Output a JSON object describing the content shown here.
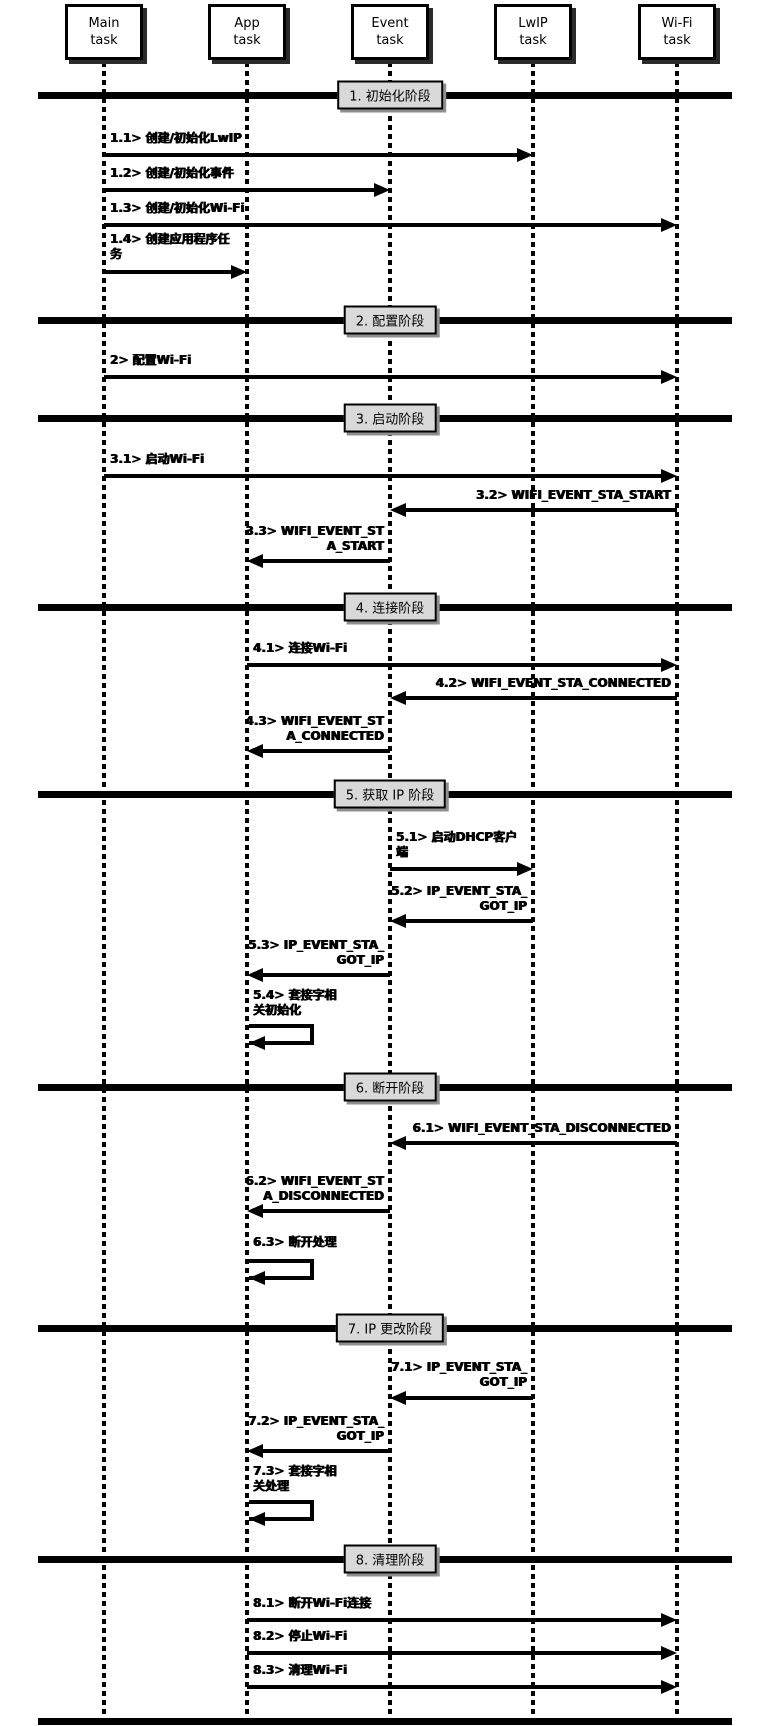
{
  "diagram": {
    "colors": {
      "line": "#000000",
      "phase_fill": "#d9d9d9",
      "box_fill": "#ffffff",
      "background": "#ffffff"
    },
    "tasks": [
      {
        "id": "main-task",
        "label": "Main task",
        "lines": [
          "Main",
          "task"
        ],
        "x": 104
      },
      {
        "id": "app-task",
        "label": "App task",
        "lines": [
          "App",
          "task"
        ],
        "x": 247
      },
      {
        "id": "event-task",
        "label": "Event task",
        "lines": [
          "Event",
          "task"
        ],
        "x": 390
      },
      {
        "id": "lwip-task",
        "label": "LwIP task",
        "lines": [
          "LwIP",
          "task"
        ],
        "x": 533
      },
      {
        "id": "wifi-task",
        "label": "Wi-Fi task",
        "lines": [
          "Wi-Fi",
          "task"
        ],
        "x": 677
      }
    ],
    "phases": [
      {
        "label": "1. 初始化阶段",
        "y": 95
      },
      {
        "label": "2. 配置阶段",
        "y": 320
      },
      {
        "label": "3. 启动阶段",
        "y": 418
      },
      {
        "label": "4. 连接阶段",
        "y": 607
      },
      {
        "label": "5. 获取 IP 阶段",
        "y": 794
      },
      {
        "label": "6. 断开阶段",
        "y": 1087
      },
      {
        "label": "7. IP 更改阶段",
        "y": 1328
      },
      {
        "label": "8. 清理阶段",
        "y": 1559
      },
      {
        "label": "",
        "y": 1721
      }
    ],
    "messages": [
      {
        "id": "1.1",
        "lines": [
          "1.1> 创建/初始化LwIP"
        ],
        "from": "main-task",
        "to": "lwip-task",
        "kind": "arrow",
        "y": 155,
        "label_y": 131
      },
      {
        "id": "1.2",
        "lines": [
          "1.2> 创建/初始化事件"
        ],
        "from": "main-task",
        "to": "event-task",
        "kind": "arrow",
        "y": 190,
        "label_y": 166
      },
      {
        "id": "1.3",
        "lines": [
          "1.3> 创建/初始化Wi-Fi"
        ],
        "from": "main-task",
        "to": "wifi-task",
        "kind": "arrow",
        "y": 225,
        "label_y": 201
      },
      {
        "id": "1.4",
        "lines": [
          "1.4> 创建应用程序任",
          "务"
        ],
        "from": "main-task",
        "to": "app-task",
        "kind": "arrow",
        "y": 272,
        "label_y": 232
      },
      {
        "id": "2",
        "lines": [
          "2> 配置Wi-Fi"
        ],
        "from": "main-task",
        "to": "wifi-task",
        "kind": "arrow",
        "y": 377,
        "label_y": 353
      },
      {
        "id": "3.1",
        "lines": [
          "3.1> 启动Wi-Fi"
        ],
        "from": "main-task",
        "to": "wifi-task",
        "kind": "arrow",
        "y": 476,
        "label_y": 452
      },
      {
        "id": "3.2",
        "lines": [
          "3.2> WIFI_EVENT_STA_START"
        ],
        "from": "wifi-task",
        "to": "event-task",
        "kind": "arrow",
        "y": 510,
        "label_y": 488
      },
      {
        "id": "3.3",
        "lines": [
          "3.3> WIFI_EVENT_ST",
          "A_START"
        ],
        "from": "event-task",
        "to": "app-task",
        "kind": "arrow",
        "y": 561,
        "label_y": 524
      },
      {
        "id": "4.1",
        "lines": [
          "4.1> 连接Wi-Fi"
        ],
        "from": "app-task",
        "to": "wifi-task",
        "kind": "arrow",
        "y": 665,
        "label_y": 641
      },
      {
        "id": "4.2",
        "lines": [
          "4.2> WIFI_EVENT_STA_CONNECTED"
        ],
        "from": "wifi-task",
        "to": "event-task",
        "kind": "arrow",
        "y": 698,
        "label_y": 676
      },
      {
        "id": "4.3",
        "lines": [
          "4.3> WIFI_EVENT_ST",
          "A_CONNECTED"
        ],
        "from": "event-task",
        "to": "app-task",
        "kind": "arrow",
        "y": 751,
        "label_y": 714
      },
      {
        "id": "5.1",
        "lines": [
          "5.1> 启动DHCP客户",
          "端"
        ],
        "from": "event-task",
        "to": "lwip-task",
        "kind": "arrow",
        "y": 869,
        "label_y": 830
      },
      {
        "id": "5.2",
        "lines": [
          "5.2> IP_EVENT_STA_",
          "GOT_IP"
        ],
        "from": "lwip-task",
        "to": "event-task",
        "kind": "arrow",
        "y": 921,
        "label_y": 884
      },
      {
        "id": "5.3",
        "lines": [
          "5.3> IP_EVENT_STA_",
          "GOT_IP"
        ],
        "from": "event-task",
        "to": "app-task",
        "kind": "arrow",
        "y": 975,
        "label_y": 938
      },
      {
        "id": "5.4",
        "lines": [
          "5.4> 套接字相",
          "关初始化"
        ],
        "from": "app-task",
        "to": "app-task",
        "kind": "self",
        "y": 1026,
        "label_y": 988
      },
      {
        "id": "6.1",
        "lines": [
          "6.1> WIFI_EVENT_STA_DISCONNECTED"
        ],
        "from": "wifi-task",
        "to": "event-task",
        "kind": "arrow",
        "y": 1143,
        "label_y": 1121
      },
      {
        "id": "6.2",
        "lines": [
          "6.2> WIFI_EVENT_ST",
          "A_DISCONNECTED"
        ],
        "from": "event-task",
        "to": "app-task",
        "kind": "arrow",
        "y": 1211,
        "label_y": 1174
      },
      {
        "id": "6.3",
        "lines": [
          "6.3> 断开处理"
        ],
        "from": "app-task",
        "to": "app-task",
        "kind": "self",
        "y": 1261,
        "label_y": 1235
      },
      {
        "id": "7.1",
        "lines": [
          "7.1> IP_EVENT_STA_",
          "GOT_IP"
        ],
        "from": "lwip-task",
        "to": "event-task",
        "kind": "arrow",
        "y": 1398,
        "label_y": 1360
      },
      {
        "id": "7.2",
        "lines": [
          "7.2> IP_EVENT_STA_",
          "GOT_IP"
        ],
        "from": "event-task",
        "to": "app-task",
        "kind": "arrow",
        "y": 1451,
        "label_y": 1414
      },
      {
        "id": "7.3",
        "lines": [
          "7.3> 套接字相",
          "关处理"
        ],
        "from": "app-task",
        "to": "app-task",
        "kind": "self",
        "y": 1502,
        "label_y": 1464
      },
      {
        "id": "8.1",
        "lines": [
          "8.1> 断开Wi-Fi连接"
        ],
        "from": "app-task",
        "to": "wifi-task",
        "kind": "arrow",
        "y": 1620,
        "label_y": 1596
      },
      {
        "id": "8.2",
        "lines": [
          "8.2> 停止Wi-Fi"
        ],
        "from": "app-task",
        "to": "wifi-task",
        "kind": "arrow",
        "y": 1653,
        "label_y": 1629
      },
      {
        "id": "8.3",
        "lines": [
          "8.3> 清理Wi-Fi"
        ],
        "from": "app-task",
        "to": "wifi-task",
        "kind": "arrow",
        "y": 1687,
        "label_y": 1663
      }
    ]
  }
}
